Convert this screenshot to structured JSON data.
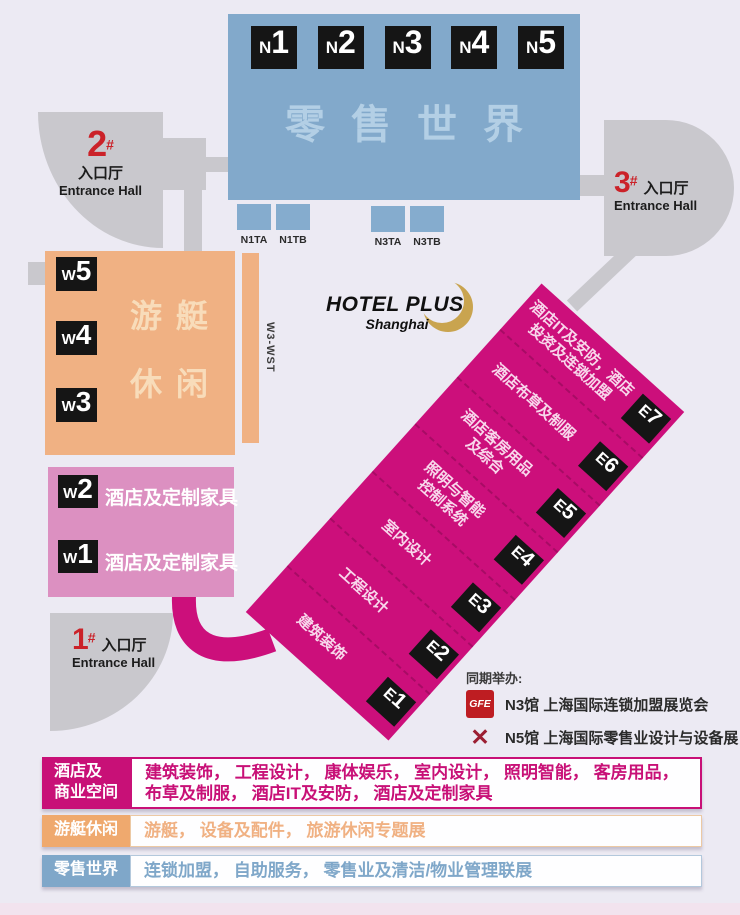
{
  "palette": {
    "background": "#ECEAF3",
    "retail_blue": "#82A9CB",
    "retail_text_blue": "#B3CFE5",
    "tab_blue": "#85ACCE",
    "yacht_orange": "#F0B183",
    "yacht_text": "#F8DCBA",
    "west_pink": "#DC90C1",
    "east_magenta": "#CC0F7B",
    "corridor_gray": "#C9C8CD",
    "badge_black": "#151515",
    "entrance_red": "#CB2229",
    "logo_gold": "#C9A44F",
    "legend_magenta": "#C81077",
    "legend_orange": "#EFA96E",
    "legend_blue": "#7FA7C9"
  },
  "retail_block": {
    "title": "零售世界",
    "halls": [
      {
        "p": "N",
        "n": "1"
      },
      {
        "p": "N",
        "n": "2"
      },
      {
        "p": "N",
        "n": "3"
      },
      {
        "p": "N",
        "n": "4"
      },
      {
        "p": "N",
        "n": "5"
      }
    ]
  },
  "tabs": {
    "left": [
      {
        "label": "N1TA"
      },
      {
        "label": "N1TB"
      }
    ],
    "right": [
      {
        "label": "N3TA"
      },
      {
        "label": "N3TB"
      }
    ]
  },
  "entrances": {
    "e2": {
      "num": "2",
      "hash": "#",
      "zh": "入口厅",
      "en": "Entrance Hall"
    },
    "e3": {
      "num": "3",
      "hash": "#",
      "zh": "入口厅",
      "en": "Entrance Hall"
    },
    "e1": {
      "num": "1",
      "hash": "#",
      "zh": "入口厅",
      "en": "Entrance Hall"
    }
  },
  "yacht_block": {
    "word1": "游艇",
    "word2": "休闲",
    "halls": [
      {
        "p": "W",
        "n": "5"
      },
      {
        "p": "W",
        "n": "4"
      },
      {
        "p": "W",
        "n": "3"
      }
    ],
    "strip_label": "W3-WST"
  },
  "west_block": {
    "rows": [
      {
        "p": "W",
        "n": "2",
        "label": "酒店及定制家具"
      },
      {
        "p": "W",
        "n": "1",
        "label": "酒店及定制家具"
      }
    ]
  },
  "east_block": {
    "rows": [
      {
        "p": "E",
        "n": "7",
        "lines": [
          "酒店IT及安防，酒店",
          "投资及连锁加盟"
        ]
      },
      {
        "p": "E",
        "n": "6",
        "lines": [
          "酒店布草及制服"
        ]
      },
      {
        "p": "E",
        "n": "5",
        "lines": [
          "酒店客房用品",
          "及综合"
        ]
      },
      {
        "p": "E",
        "n": "4",
        "lines": [
          "照明与智能",
          "控制系统"
        ]
      },
      {
        "p": "E",
        "n": "3",
        "lines": [
          "室内设计"
        ]
      },
      {
        "p": "E",
        "n": "2",
        "lines": [
          "工程设计"
        ]
      },
      {
        "p": "E",
        "n": "1",
        "lines": [
          "建筑装饰"
        ]
      }
    ]
  },
  "logo": {
    "title": "HOTEL PLUS",
    "subtitle": "Shanghai"
  },
  "concurrent": {
    "heading": "同期举办:",
    "items": [
      {
        "badge": "GFE",
        "text": "N3馆 上海国际连锁加盟展览会"
      },
      {
        "badge": "✕",
        "text": "N5馆 上海国际零售业设计与设备展"
      }
    ]
  },
  "legend": {
    "rows": [
      {
        "label_lines": [
          "酒店及",
          "商业空间"
        ],
        "content_lines": [
          "建筑装饰， 工程设计， 康体娱乐， 室内设计， 照明智能， 客房用品，",
          "布草及制服， 酒店IT及安防， 酒店及定制家具"
        ]
      },
      {
        "label_lines": [
          "游艇休闲"
        ],
        "content_lines": [
          "游艇， 设备及配件， 旅游休闲专题展"
        ]
      },
      {
        "label_lines": [
          "零售世界"
        ],
        "content_lines": [
          "连锁加盟， 自助服务， 零售业及清洁/物业管理联展"
        ]
      }
    ]
  }
}
